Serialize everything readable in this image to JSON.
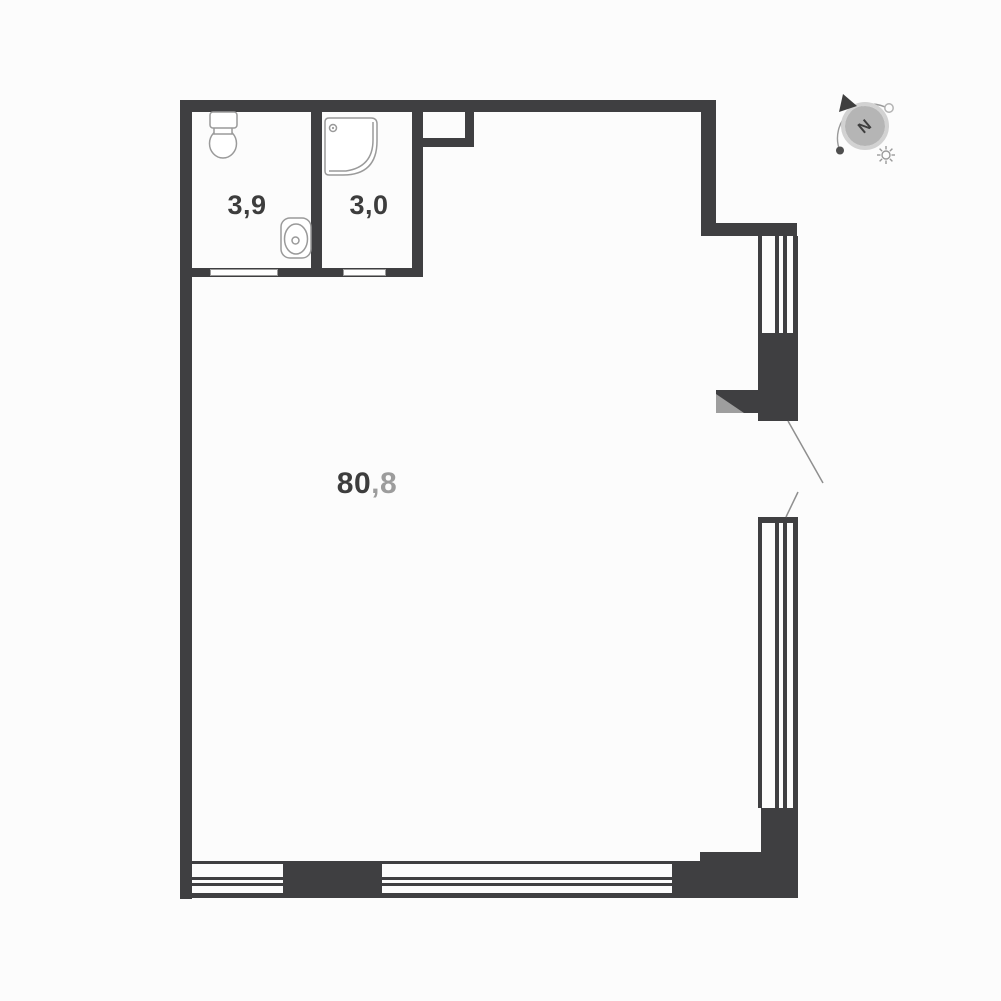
{
  "plan": {
    "type": "apartment-floor-plan",
    "rooms": {
      "bathroom": {
        "area": "3,9"
      },
      "shower_room": {
        "area": "3,0"
      },
      "living_room": {
        "area_whole": "80",
        "area_fraction": ",8"
      }
    },
    "compass": {
      "north_label": "N"
    },
    "icons": [
      "toilet-icon",
      "sink-icon",
      "shower-tray-icon",
      "compass-icon",
      "north-arrow-icon",
      "sun-icon"
    ],
    "colors": {
      "wall": "#3f3f41",
      "fixture_outline": "#9a9a9a",
      "area_text": "#3d3d3d",
      "area_fraction_text": "#9c9c9c",
      "compass_disc": "#b5b5b5",
      "shadow": "#9e9e9e",
      "background": "#fcfcfc"
    }
  }
}
